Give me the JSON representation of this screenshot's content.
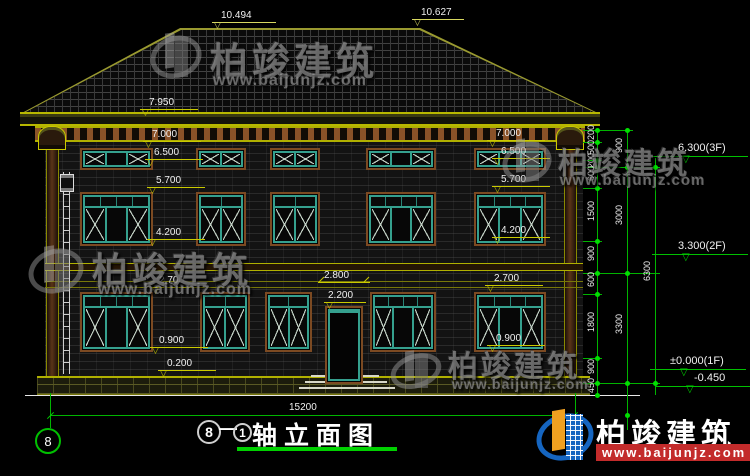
{
  "title": {
    "axis_bubble": "8",
    "circle_left": "8",
    "dash": "—",
    "circle_right": "1",
    "text": "轴立面图",
    "total_width": "15200"
  },
  "roof": {
    "ridge_left": "10.494",
    "ridge_right": "10.627",
    "eave": "7.950"
  },
  "levels": {
    "left": [
      "7.000",
      "6.500",
      "5.700",
      "4.200",
      "2.700",
      "0.900",
      "0.200"
    ],
    "right": [
      "7.000",
      "6.500",
      "5.700",
      "4.200",
      "2.700",
      "0.900"
    ],
    "door": [
      "2.800",
      "2.200"
    ]
  },
  "chains": {
    "c1": [
      "200",
      "500",
      "200",
      "600",
      "1500",
      "900",
      "600",
      "1800",
      "900",
      "450"
    ],
    "c2": [
      "900",
      "3000",
      "3300"
    ],
    "c3": [
      "6300"
    ]
  },
  "floor_elevations": [
    "6.300(3F)",
    "3.300(2F)",
    "±0.000(1F)",
    "-0.450"
  ],
  "watermark": {
    "brand": "柏竣建筑",
    "url": "www.baijunjz.com"
  },
  "logo": {
    "brand": "柏竣建筑",
    "url": "www.baijunjz.com"
  },
  "colors": {
    "background": "#000000",
    "dim_yellow": "#caca00",
    "cad_green": "#00d000",
    "window_teal": "#35a08e",
    "surround_brown": "#7c4a22",
    "logo_blue": "#1565c0",
    "logo_orange": "#f0a020",
    "logo_red": "#c32b2b"
  }
}
